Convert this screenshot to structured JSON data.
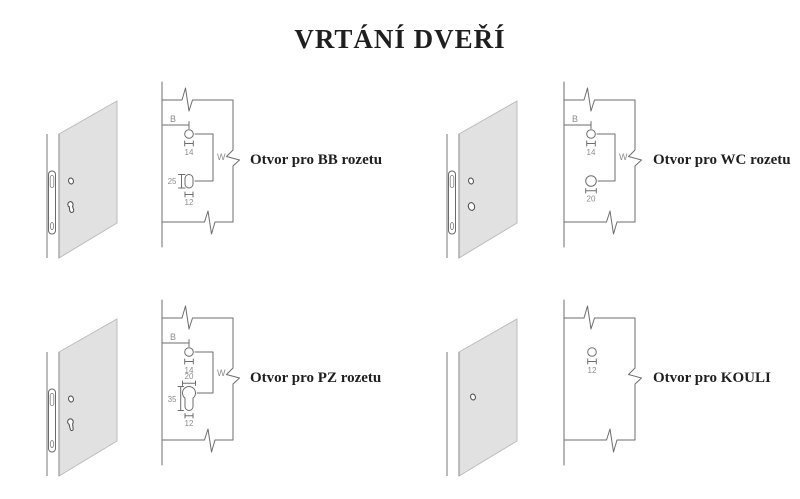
{
  "title": "VRTÁNÍ DVEŘÍ",
  "colors": {
    "background": "#ffffff",
    "door_panel_fill": "#e1e1e1",
    "drawing_line": "#6e6e6e",
    "dimension_text": "#8c8c8c",
    "label_text": "#1f1f1f"
  },
  "sections": [
    {
      "id": "bb",
      "label": "Otvor pro BB rozetu",
      "dims": {
        "edge_offset": "B",
        "spacing": "W",
        "top_hole_dia": "14",
        "bottom_hole_height": "25",
        "bottom_hole_width": "12"
      }
    },
    {
      "id": "wc",
      "label": "Otvor pro WC rozetu",
      "dims": {
        "edge_offset": "B",
        "spacing": "W",
        "top_hole_dia": "14",
        "bottom_hole_dia": "20"
      }
    },
    {
      "id": "pz",
      "label": "Otvor pro PZ rozetu",
      "dims": {
        "edge_offset": "B",
        "spacing": "W",
        "top_hole_dia": "14",
        "cylinder_width": "20",
        "cylinder_height": "35",
        "cylinder_slot_width": "12"
      }
    },
    {
      "id": "kouli",
      "label": "Otvor pro KOULI",
      "dims": {
        "hole_dia": "12"
      }
    }
  ]
}
